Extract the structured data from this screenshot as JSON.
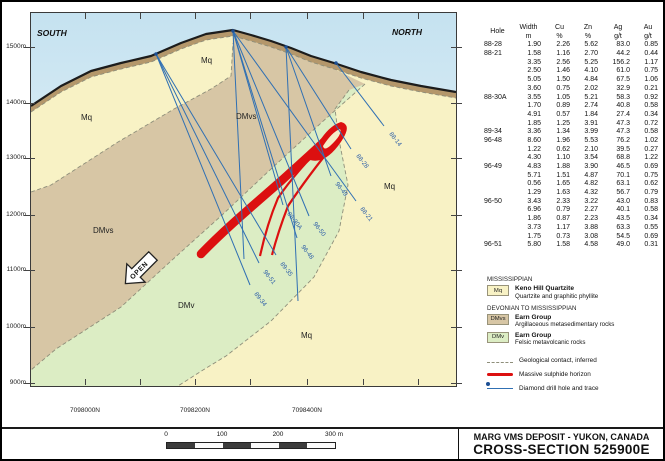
{
  "title_block": {
    "line1": "MARG VMS DEPOSIT - YUKON, CANADA",
    "line2": "CROSS-SECTION 525900E"
  },
  "colors": {
    "sky": "#c9e4f1",
    "mq": "#f8f2c5",
    "dmvs": "#d7c6a5",
    "dmv": "#dcedc4",
    "band": "#b4976b",
    "sulphide": "#dc1010",
    "drill": "#3070b3"
  },
  "section": {
    "south_label": "SOUTH",
    "north_label": "NORTH",
    "open_label": "OPEN",
    "elevation_ticks": [
      {
        "label": "1500m",
        "y": 47
      },
      {
        "label": "1400m",
        "y": 103
      },
      {
        "label": "1300m",
        "y": 158
      },
      {
        "label": "1200m",
        "y": 215
      },
      {
        "label": "1100m",
        "y": 270
      },
      {
        "label": "1000m",
        "y": 327
      },
      {
        "label": "900m",
        "y": 383
      }
    ],
    "northing_ticks": [
      {
        "label": "7098000N",
        "x": 85
      },
      {
        "label": "",
        "x": 140
      },
      {
        "label": "7098200N",
        "x": 195
      },
      {
        "label": "",
        "x": 250
      },
      {
        "label": "7098400N",
        "x": 307
      },
      {
        "label": "",
        "x": 363
      },
      {
        "label": "",
        "x": 418
      }
    ],
    "unit_labels": [
      {
        "text": "Mq",
        "x": 50,
        "y": 107
      },
      {
        "text": "Mq",
        "x": 170,
        "y": 50
      },
      {
        "text": "Mq",
        "x": 353,
        "y": 176
      },
      {
        "text": "Mq",
        "x": 270,
        "y": 325
      },
      {
        "text": "DMvs",
        "x": 205,
        "y": 106
      },
      {
        "text": "DMvs",
        "x": 62,
        "y": 220
      },
      {
        "text": "DMv",
        "x": 147,
        "y": 295
      }
    ],
    "drill_holes": [
      {
        "id": "88-14",
        "x1": 305,
        "y1": 50,
        "x2": 353,
        "y2": 113,
        "lx": 358,
        "ly": 121
      },
      {
        "id": "88-28",
        "x1": 255,
        "y1": 34,
        "x2": 320,
        "y2": 136,
        "lx": 325,
        "ly": 143
      },
      {
        "id": "96-49",
        "x1": 255,
        "y1": 34,
        "x2": 300,
        "y2": 163,
        "lx": 304,
        "ly": 171
      },
      {
        "id": "88-21",
        "x1": 202,
        "y1": 18,
        "x2": 325,
        "y2": 188,
        "lx": 329,
        "ly": 196
      },
      {
        "id": "96-50",
        "x1": 202,
        "y1": 18,
        "x2": 278,
        "y2": 203,
        "lx": 282,
        "ly": 211
      },
      {
        "id": "88-30A",
        "x1": 202,
        "y1": 18,
        "x2": 252,
        "y2": 192,
        "lx": 256,
        "ly": 201
      },
      {
        "id": "96-48",
        "x1": 202,
        "y1": 18,
        "x2": 266,
        "y2": 225,
        "lx": 270,
        "ly": 234
      },
      {
        "id": "89-35",
        "x1": 125,
        "y1": 41,
        "x2": 245,
        "y2": 242,
        "lx": 249,
        "ly": 251
      },
      {
        "id": "96-51",
        "x1": 125,
        "y1": 41,
        "x2": 228,
        "y2": 250,
        "lx": 232,
        "ly": 259
      },
      {
        "id": "89-34",
        "x1": 125,
        "y1": 41,
        "x2": 219,
        "y2": 272,
        "lx": 223,
        "ly": 281
      }
    ],
    "extra_traces": [
      {
        "x1": 255,
        "y1": 34,
        "x2": 267,
        "y2": 288
      },
      {
        "x1": 202,
        "y1": 18,
        "x2": 213,
        "y2": 246
      }
    ],
    "collars": [
      [
        125,
        41
      ],
      [
        202,
        18
      ],
      [
        255,
        34
      ],
      [
        305,
        50
      ]
    ]
  },
  "table": {
    "col_headers": [
      {
        "l1": "Hole",
        "l2": ""
      },
      {
        "l1": "Width",
        "l2": "m"
      },
      {
        "l1": "Cu",
        "l2": "%"
      },
      {
        "l1": "Zn",
        "l2": "%"
      },
      {
        "l1": "Ag",
        "l2": "g/t"
      },
      {
        "l1": "Au",
        "l2": "g/t"
      }
    ],
    "rows": [
      [
        "88-28",
        "1.90",
        "2.26",
        "5.62",
        "83.0",
        "0.85"
      ],
      [
        "88-21",
        "1.58",
        "1.16",
        "2.70",
        "44.2",
        "0.44"
      ],
      [
        "",
        "3.35",
        "2.56",
        "5.25",
        "156.2",
        "1.17"
      ],
      [
        "",
        "2.50",
        "1.46",
        "4.10",
        "61.0",
        "0.75"
      ],
      [
        "",
        "5.05",
        "1.50",
        "4.84",
        "67.5",
        "1.06"
      ],
      [
        "",
        "3.60",
        "0.75",
        "2.02",
        "32.9",
        "0.21"
      ],
      [
        "88-30A",
        "3.55",
        "1.05",
        "5.21",
        "58.3",
        "0.92"
      ],
      [
        "",
        "1.70",
        "0.89",
        "2.74",
        "40.8",
        "0.58"
      ],
      [
        "",
        "4.91",
        "0.57",
        "1.84",
        "27.4",
        "0.34"
      ],
      [
        "",
        "1.85",
        "1.25",
        "3.91",
        "47.3",
        "0.72"
      ],
      [
        "89-34",
        "3.36",
        "1.34",
        "3.99",
        "47.3",
        "0.58"
      ],
      [
        "96-48",
        "8.60",
        "1.96",
        "5.53",
        "76.2",
        "1.02"
      ],
      [
        "",
        "1.22",
        "0.62",
        "2.10",
        "39.5",
        "0.27"
      ],
      [
        "",
        "4.30",
        "1.10",
        "3.54",
        "68.8",
        "1.22"
      ],
      [
        "96-49",
        "4.83",
        "1.88",
        "3.90",
        "46.5",
        "0.69"
      ],
      [
        "",
        "5.71",
        "1.51",
        "4.87",
        "70.1",
        "0.75"
      ],
      [
        "",
        "0.56",
        "1.65",
        "4.82",
        "63.1",
        "0.62"
      ],
      [
        "",
        "1.29",
        "1.63",
        "4.32",
        "56.7",
        "0.79"
      ],
      [
        "96-50",
        "3.43",
        "2.33",
        "3.22",
        "43.0",
        "0.83"
      ],
      [
        "",
        "6.96",
        "0.79",
        "2.27",
        "40.1",
        "0.58"
      ],
      [
        "",
        "1.86",
        "0.87",
        "2.23",
        "43.5",
        "0.34"
      ],
      [
        "",
        "3.73",
        "1.17",
        "3.88",
        "63.3",
        "0.55"
      ],
      [
        "",
        "1.75",
        "0.73",
        "3.08",
        "54.5",
        "0.69"
      ],
      [
        "96-51",
        "5.80",
        "1.58",
        "4.58",
        "49.0",
        "0.31"
      ]
    ]
  },
  "legend": {
    "era1": "MISSISSIPPIAN",
    "era2": "DEVONIAN TO MISSISSIPPIAN",
    "units": [
      {
        "code": "Mq",
        "name": "Keno Hill Quartzite",
        "desc": "Quartzite and graphitic phyllite"
      },
      {
        "code": "DMvs",
        "name": "Earn Group",
        "desc": "Argillaceous metasedimentary rocks"
      },
      {
        "code": "DMv",
        "name": "Earn Group",
        "desc": "Felsic metavolcanic rocks"
      }
    ],
    "symbols": [
      {
        "label": "Geological contact, inferred"
      },
      {
        "label": "Massive sulphide horizon"
      },
      {
        "label": "Diamond drill hole and trace"
      }
    ]
  },
  "scalebar": {
    "labels": [
      {
        "text": "0",
        "x": 0
      },
      {
        "text": "100",
        "x": 56
      },
      {
        "text": "200",
        "x": 112
      },
      {
        "text": "300 m",
        "x": 168
      }
    ]
  }
}
